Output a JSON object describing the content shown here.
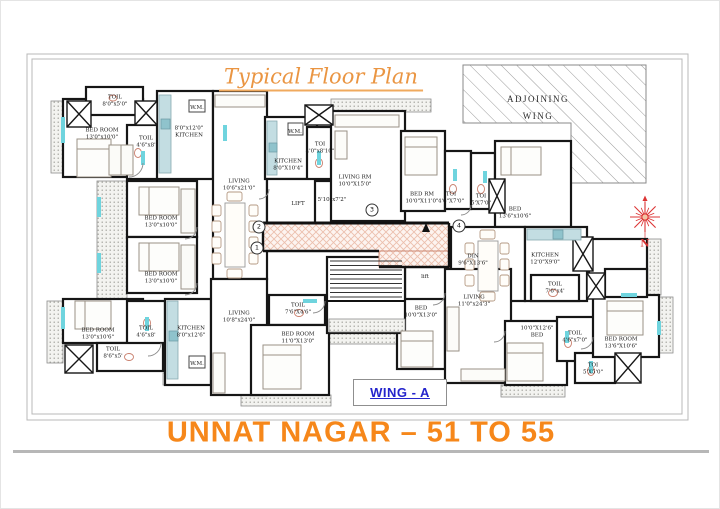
{
  "title": "Typical Floor Plan",
  "project_title": "UNNAT NAGAR – 51 TO 55",
  "wing_label": "WING - A",
  "adjoining_wing": {
    "line1": "ADJOINING",
    "line2": "WING"
  },
  "compass": {
    "n": "N"
  },
  "markers": [
    "1",
    "2",
    "3",
    "4"
  ],
  "colors": {
    "title_orange": "#EA9542",
    "project_orange": "#F6871A",
    "wing_blue": "#2424CC",
    "compass_red": "#D83434",
    "wall_black": "#161616",
    "corridor_pink": "#ECBFAD",
    "fixture_cyan": "#6FD4DE"
  },
  "rooms": [
    {
      "line1": "TOIL",
      "line2": "8'0\"x5'0\""
    },
    {
      "line1": "BED ROOM",
      "line2": "13'0\"x10'0\""
    },
    {
      "line1": "TOIL",
      "line2": "4'6\"x8'"
    },
    {
      "line1": "8'0\"x12'0\"",
      "line2": "KITCHEN"
    },
    {
      "line1": "W.M.",
      "line2": ""
    },
    {
      "line1": "LIVING",
      "line2": "10'6\"x21'0\""
    },
    {
      "line1": "W.M.",
      "line2": ""
    },
    {
      "line1": "KITCHEN",
      "line2": "8'0\"X10'4\""
    },
    {
      "line1": "TOI",
      "line2": "4'0\"x8'10\""
    },
    {
      "line1": "LIFT",
      "line2": ""
    },
    {
      "line1": "5'10\"x7'2\"",
      "line2": ""
    },
    {
      "line1": "LIVING RM",
      "line2": "10'0\"X15'0\""
    },
    {
      "line1": "BED RM",
      "line2": "10'0\"X11'0\""
    },
    {
      "line1": "TOI",
      "line2": "4'6\"X7'0\""
    },
    {
      "line1": "TOI",
      "line2": "5'X7'0\""
    },
    {
      "line1": "BED",
      "line2": "13'6\"x10'6\""
    },
    {
      "line1": "DIN",
      "line2": "9'6\"X13'6\""
    },
    {
      "line1": "KITCHEN",
      "line2": "12'0\"X9'0\""
    },
    {
      "line1": "TOIL",
      "line2": "7'6\"x4'"
    },
    {
      "line1": "BED ROOM",
      "line2": "13'0\"x10'0\""
    },
    {
      "line1": "BED ROOM",
      "line2": "13'0\"x10'0\""
    },
    {
      "line1": "BED ROOM",
      "line2": "13'0\"x10'6\""
    },
    {
      "line1": "TOIL",
      "line2": "4'6\"x8'"
    },
    {
      "line1": "KITCHEN",
      "line2": "8'0\"x12'6\""
    },
    {
      "line1": "TOIL",
      "line2": "8'6\"x5'"
    },
    {
      "line1": "W.M.",
      "line2": ""
    },
    {
      "line1": "LIVING",
      "line2": "10'8\"x24'0\""
    },
    {
      "line1": "TOIL",
      "line2": "7'6\"X4'6\""
    },
    {
      "line1": "BED ROOM",
      "line2": "11'0\"X13'0\""
    },
    {
      "line1": "lift",
      "line2": ""
    },
    {
      "line1": "BED",
      "line2": "10'0\"X13'0\""
    },
    {
      "line1": "LIVING",
      "line2": "11'0\"x24'3\""
    },
    {
      "line1": "10'0\"X12'6\"",
      "line2": "BED"
    },
    {
      "line1": "TOIL",
      "line2": "4'6\"x7'0\""
    },
    {
      "line1": "TOI",
      "line2": "5'X5'0\""
    },
    {
      "line1": "BED ROOM",
      "line2": "13'6\"X10'6\""
    }
  ]
}
